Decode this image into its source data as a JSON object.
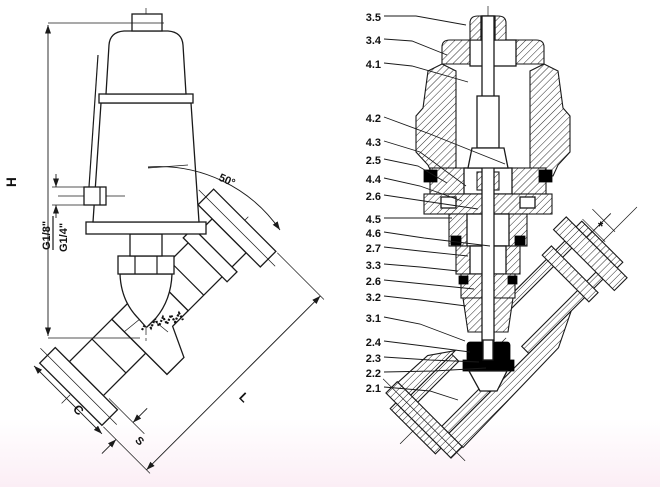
{
  "page": {
    "background_top": "#ffffff",
    "background_bottom": "#fbeef5",
    "line_color": "#1a1a1a"
  },
  "left_view": {
    "description": "angle-seat-valve-external-view",
    "labels": {
      "height": "H",
      "pilot_port_thread_1": "G1/8\"",
      "pilot_port_thread_2": "G1/4\"",
      "seat_angle": "50°",
      "dim_c": "C",
      "dim_s": "S",
      "dim_l": "L"
    }
  },
  "right_view": {
    "description": "angle-seat-valve-sectional-view",
    "flange_dim_note": "*",
    "callouts": [
      {
        "label": "3.5"
      },
      {
        "label": "3.4"
      },
      {
        "label": "4.1"
      },
      {
        "label": "4.2"
      },
      {
        "label": "4.3"
      },
      {
        "label": "2.5"
      },
      {
        "label": "4.4"
      },
      {
        "label": "2.6"
      },
      {
        "label": "4.5"
      },
      {
        "label": "4.6"
      },
      {
        "label": "2.7"
      },
      {
        "label": "3.3"
      },
      {
        "label": "2.6"
      },
      {
        "label": "3.2"
      },
      {
        "label": "3.1"
      },
      {
        "label": "2.4"
      },
      {
        "label": "2.3"
      },
      {
        "label": "2.2"
      },
      {
        "label": "2.1"
      }
    ]
  }
}
